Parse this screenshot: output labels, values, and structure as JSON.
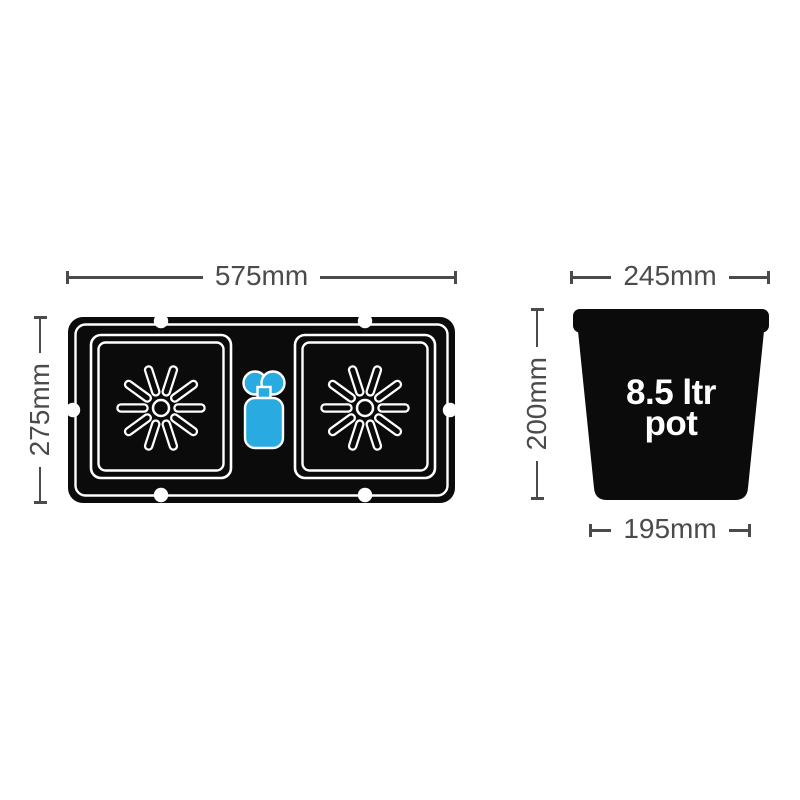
{
  "tray_diagram": {
    "width_label": "575mm",
    "height_label": "275mm",
    "icons": {
      "pot_position_marker": "starburst-icon",
      "valve": "aquavalve-icon",
      "edge_holes": "grommet-dot-icon"
    }
  },
  "pot_diagram": {
    "top_width_label": "245mm",
    "height_label": "200mm",
    "bottom_width_label": "195mm",
    "capacity_label": {
      "line1": "8.5 ltr",
      "line2": "pot"
    }
  },
  "colors": {
    "diagram_black": "#0b0b0b",
    "valve_blue": "#29abe2",
    "dimension_gray": "#4b4b4d",
    "outline_white": "#ffffff",
    "background": "#ffffff"
  }
}
